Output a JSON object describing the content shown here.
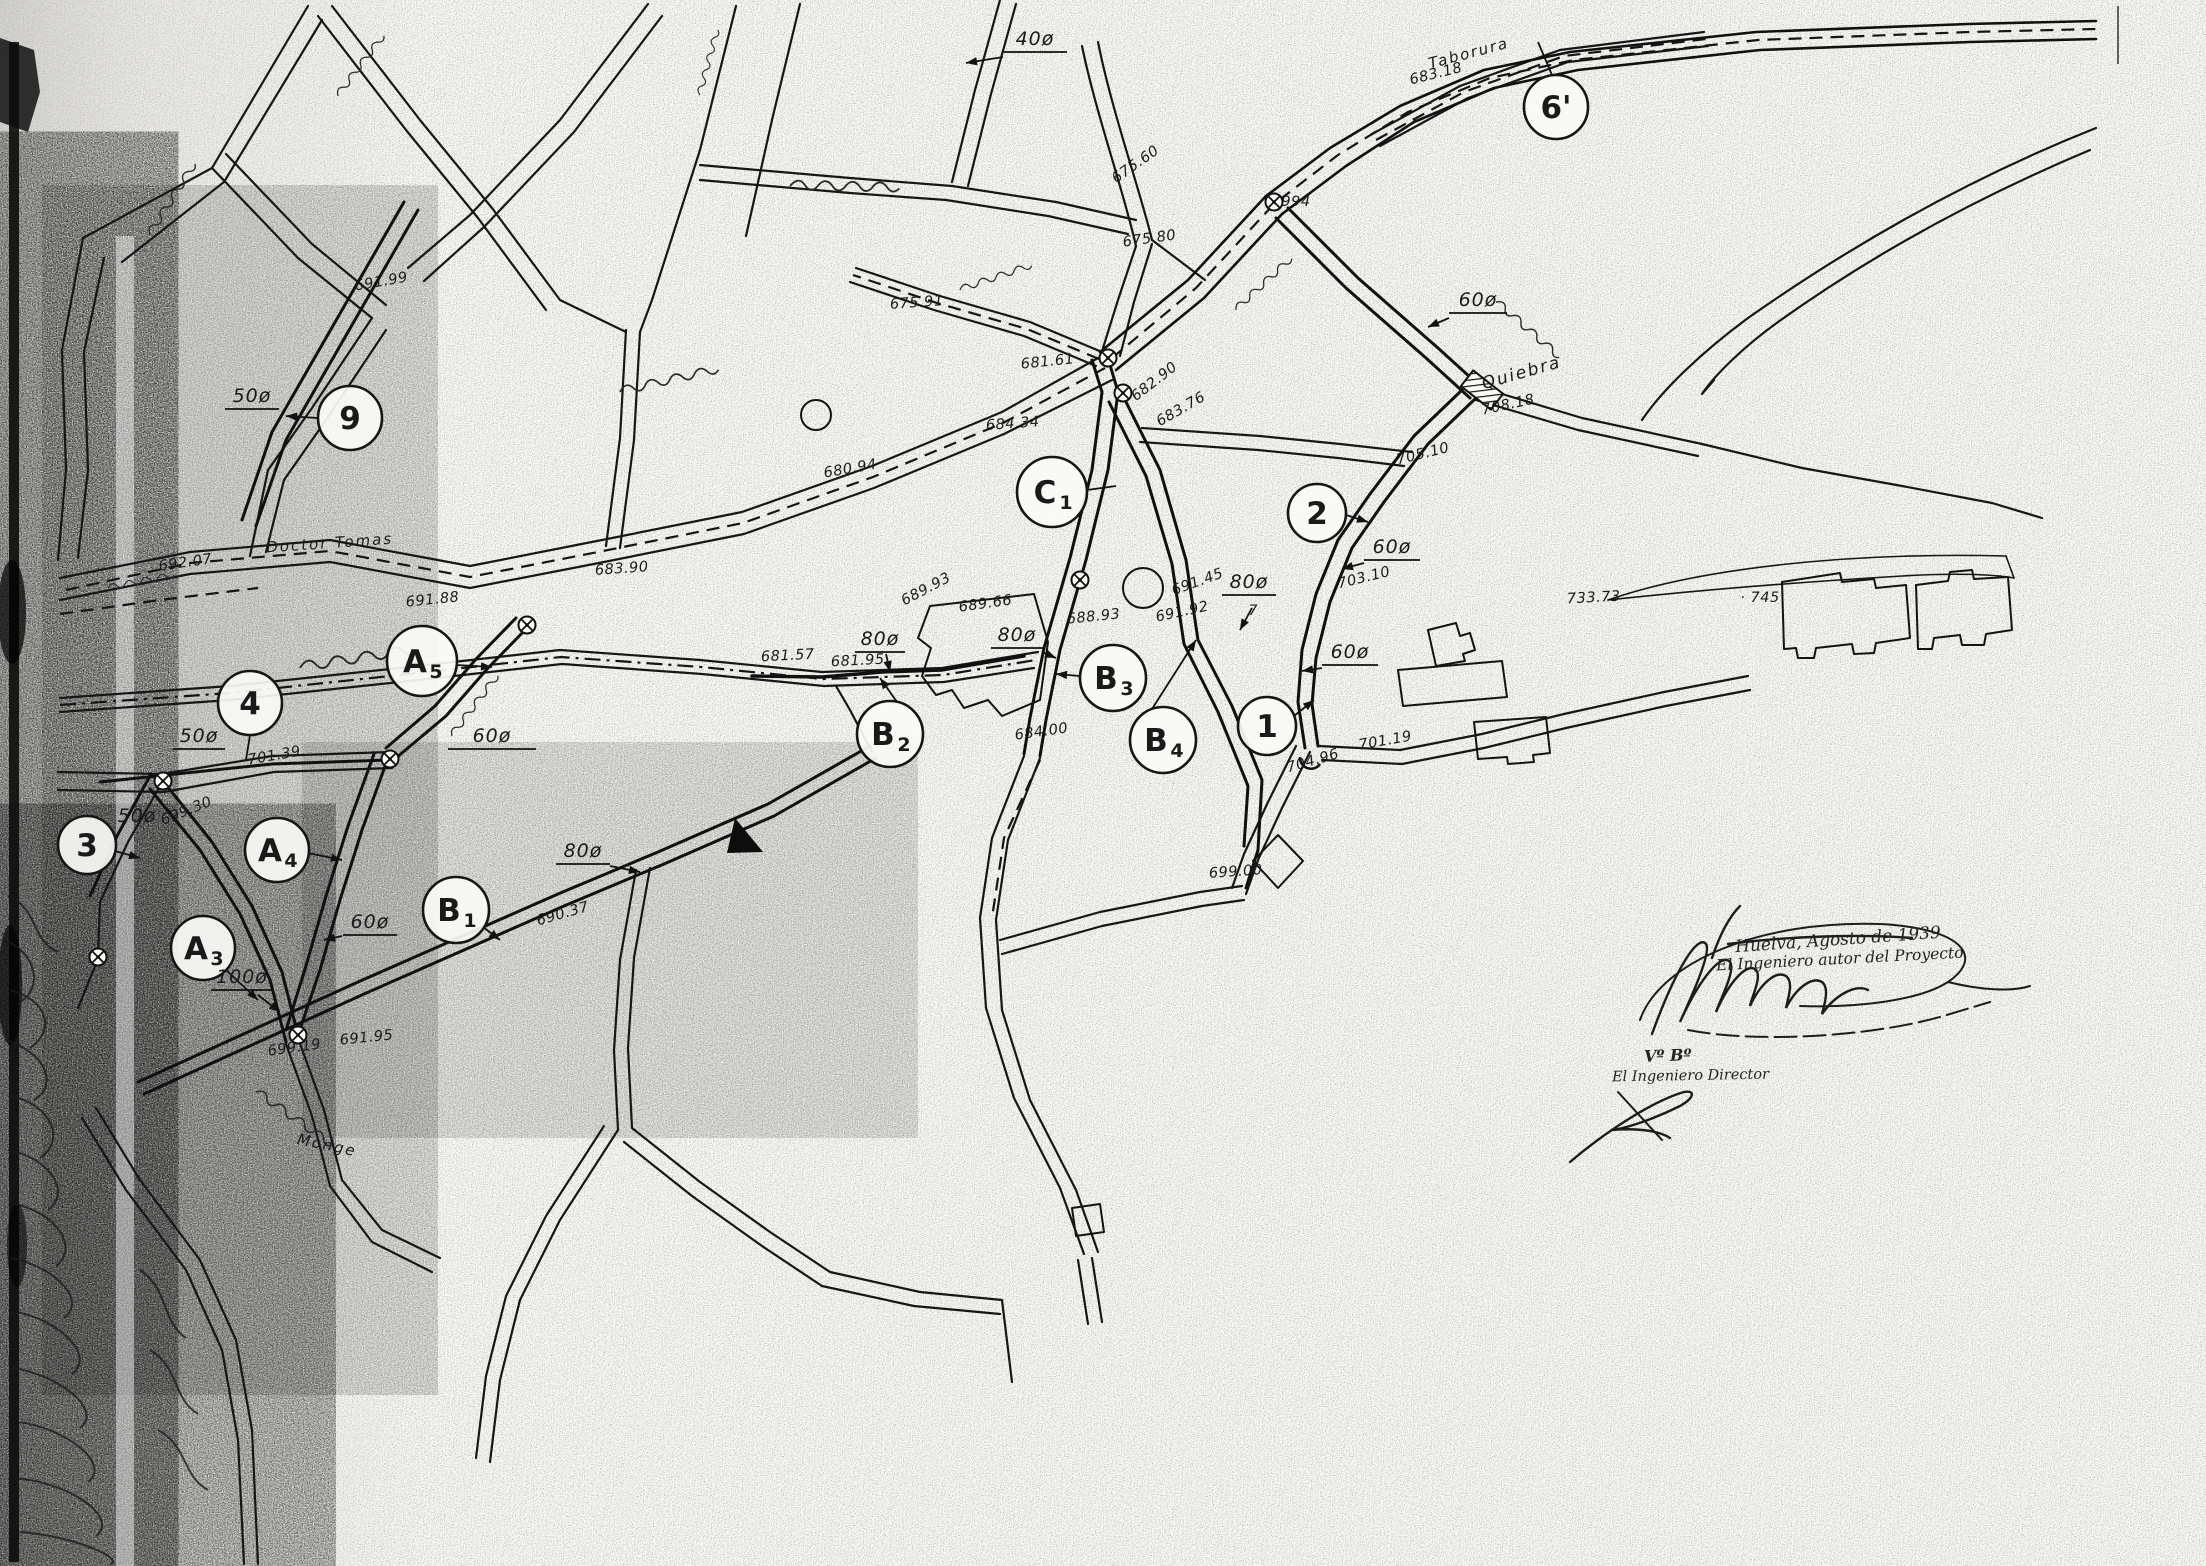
{
  "signatures": {
    "author_block": {
      "place_date": "Huelva, Agosto de 1939",
      "role": "El Ingeniero autor del Proyecto"
    },
    "approval_block": {
      "seen": "Vº Bº",
      "role": "El Ingeniero Director"
    }
  },
  "street_names": [
    {
      "t": "Quiebra",
      "x": 1523,
      "y": 378,
      "rot": -16,
      "size": 17
    },
    {
      "t": "Doctor Tomas",
      "x": 330,
      "y": 548,
      "rot": -4,
      "size": 15
    },
    {
      "t": "Taborura",
      "x": 1470,
      "y": 58,
      "rot": -15,
      "size": 15
    },
    {
      "t": "Monge",
      "x": 326,
      "y": 1150,
      "rot": 12,
      "size": 15
    }
  ],
  "node_labels": [
    {
      "t": "9",
      "sub": "",
      "x": 350,
      "y": 418,
      "r": 32,
      "leader": [
        318,
        418,
        286,
        416
      ],
      "arrow": true
    },
    {
      "t": "4",
      "sub": "",
      "x": 250,
      "y": 703,
      "r": 32,
      "leader": [
        250,
        735,
        246,
        760
      ],
      "arrow": false
    },
    {
      "t": "3",
      "sub": "",
      "x": 87,
      "y": 845,
      "r": 29,
      "leader": [
        115,
        851,
        140,
        858
      ],
      "arrow": true
    },
    {
      "t": "A",
      "sub": "5",
      "x": 422,
      "y": 661,
      "r": 35,
      "leader": [
        456,
        665,
        492,
        667
      ],
      "arrow": true
    },
    {
      "t": "A",
      "sub": "4",
      "x": 277,
      "y": 850,
      "r": 32,
      "leader": [
        308,
        853,
        342,
        860
      ],
      "arrow": true
    },
    {
      "t": "A",
      "sub": "3",
      "x": 203,
      "y": 948,
      "r": 32,
      "leader": [
        226,
        970,
        258,
        1000
      ],
      "arrow": true
    },
    {
      "t": "B",
      "sub": "1",
      "x": 456,
      "y": 910,
      "r": 33,
      "leader": [
        483,
        927,
        500,
        940
      ],
      "arrow": true
    },
    {
      "t": "B",
      "sub": "2",
      "x": 890,
      "y": 734,
      "r": 33,
      "leader": [
        897,
        702,
        880,
        678
      ],
      "arrow": true
    },
    {
      "t": "B",
      "sub": "3",
      "x": 1113,
      "y": 678,
      "r": 33,
      "leader": [
        1080,
        676,
        1056,
        674
      ],
      "arrow": true
    },
    {
      "t": "B",
      "sub": "4",
      "x": 1163,
      "y": 740,
      "r": 33,
      "leader": [
        1152,
        709,
        1196,
        640
      ],
      "arrow": true
    },
    {
      "t": "C",
      "sub": "1",
      "x": 1052,
      "y": 492,
      "r": 35,
      "leader": [
        1087,
        490,
        1116,
        486
      ],
      "arrow": false
    },
    {
      "t": "1",
      "sub": "",
      "x": 1267,
      "y": 726,
      "r": 29,
      "leader": [
        1294,
        716,
        1314,
        700
      ],
      "arrow": true
    },
    {
      "t": "2",
      "sub": "",
      "x": 1317,
      "y": 513,
      "r": 29,
      "leader": [
        1346,
        515,
        1368,
        522
      ],
      "arrow": true
    },
    {
      "t": "6'",
      "sub": "",
      "x": 1556,
      "y": 107,
      "r": 32,
      "leader": [
        1552,
        75,
        1538,
        42
      ],
      "arrow": false
    }
  ],
  "diameter_labels": [
    {
      "t": "40ø",
      "x": 1035,
      "y": 45,
      "ul": 64,
      "arrow": [
        1003,
        57,
        966,
        63
      ],
      "sub": ""
    },
    {
      "t": "50ø",
      "x": 252,
      "y": 402,
      "ul": 54,
      "arrow": null,
      "sub": ""
    },
    {
      "t": "50ø",
      "x": 199,
      "y": 742,
      "ul": 52,
      "arrow": null,
      "sub": ""
    },
    {
      "t": "50ø",
      "x": 137,
      "y": 822,
      "ul": 0,
      "arrow": null,
      "sub": ""
    },
    {
      "t": "60ø",
      "x": 1478,
      "y": 306,
      "ul": 58,
      "arrow": [
        1449,
        318,
        1428,
        327
      ],
      "sub": ""
    },
    {
      "t": "60ø",
      "x": 1392,
      "y": 553,
      "ul": 56,
      "arrow": [
        1364,
        563,
        1342,
        569
      ],
      "sub": ""
    },
    {
      "t": "60ø",
      "x": 1350,
      "y": 658,
      "ul": 56,
      "arrow": [
        1322,
        668,
        1302,
        671
      ],
      "sub": ""
    },
    {
      "t": "60ø",
      "x": 492,
      "y": 742,
      "ul": 88,
      "arrow": null,
      "sub": ""
    },
    {
      "t": "60ø",
      "x": 370,
      "y": 928,
      "ul": 54,
      "arrow": [
        342,
        936,
        324,
        940
      ],
      "sub": ""
    },
    {
      "t": "80ø",
      "x": 583,
      "y": 857,
      "ul": 54,
      "arrow": [
        610,
        866,
        640,
        872
      ],
      "sub": ""
    },
    {
      "t": "80ø",
      "x": 880,
      "y": 645,
      "ul": 50,
      "arrow": [
        886,
        654,
        890,
        672
      ],
      "sub": ""
    },
    {
      "t": "80ø",
      "x": 1017,
      "y": 641,
      "ul": 52,
      "arrow": [
        1042,
        652,
        1056,
        658
      ],
      "sub": ""
    },
    {
      "t": "80ø",
      "x": 1249,
      "y": 588,
      "ul": 54,
      "arrow": [
        1252,
        608,
        1240,
        630
      ],
      "sub": "7"
    },
    {
      "t": "100ø",
      "x": 242,
      "y": 983,
      "ul": 62,
      "arrow": [
        258,
        995,
        280,
        1012
      ],
      "sub": ""
    }
  ],
  "elevation_labels": [
    {
      "t": "691.99",
      "x": 382,
      "y": 286,
      "rot": -10
    },
    {
      "t": "675.91",
      "x": 917,
      "y": 307,
      "rot": -4
    },
    {
      "t": "675.60",
      "x": 1138,
      "y": 168,
      "rot": -35
    },
    {
      "t": "675.80",
      "x": 1150,
      "y": 243,
      "rot": -8
    },
    {
      "t": "683.18",
      "x": 1437,
      "y": 78,
      "rot": -14
    },
    {
      "t": "994",
      "x": 1296,
      "y": 206,
      "rot": 0
    },
    {
      "t": "682.90",
      "x": 1157,
      "y": 385,
      "rot": -38
    },
    {
      "t": "683.76",
      "x": 1183,
      "y": 413,
      "rot": -30
    },
    {
      "t": "681.61",
      "x": 1048,
      "y": 366,
      "rot": -6
    },
    {
      "t": "684.34",
      "x": 1013,
      "y": 428,
      "rot": -4
    },
    {
      "t": "680.94",
      "x": 851,
      "y": 473,
      "rot": -10
    },
    {
      "t": "692.07",
      "x": 186,
      "y": 567,
      "rot": -8
    },
    {
      "t": "691.88",
      "x": 433,
      "y": 604,
      "rot": -6
    },
    {
      "t": "683.90",
      "x": 622,
      "y": 573,
      "rot": -4
    },
    {
      "t": "681.57",
      "x": 788,
      "y": 660,
      "rot": -3
    },
    {
      "t": "681.95",
      "x": 858,
      "y": 665,
      "rot": -3
    },
    {
      "t": "689.93",
      "x": 928,
      "y": 593,
      "rot": -28
    },
    {
      "t": "689.66",
      "x": 986,
      "y": 608,
      "rot": -8
    },
    {
      "t": "688.93",
      "x": 1094,
      "y": 621,
      "rot": -6
    },
    {
      "t": "691.45",
      "x": 1199,
      "y": 586,
      "rot": -20
    },
    {
      "t": "691.92",
      "x": 1183,
      "y": 616,
      "rot": -12
    },
    {
      "t": "684.00",
      "x": 1042,
      "y": 736,
      "rot": -8
    },
    {
      "t": "705.10",
      "x": 1424,
      "y": 458,
      "rot": -14
    },
    {
      "t": "708.18",
      "x": 1509,
      "y": 409,
      "rot": -12
    },
    {
      "t": "703.10",
      "x": 1365,
      "y": 582,
      "rot": -14
    },
    {
      "t": "704.96",
      "x": 1314,
      "y": 765,
      "rot": -16
    },
    {
      "t": "701.19",
      "x": 1386,
      "y": 745,
      "rot": -10
    },
    {
      "t": "699.00",
      "x": 1236,
      "y": 876,
      "rot": -4
    },
    {
      "t": "733.73",
      "x": 1594,
      "y": 602,
      "rot": -3
    },
    {
      "t": "· 745",
      "x": 1760,
      "y": 602,
      "rot": 0
    },
    {
      "t": "690.37",
      "x": 564,
      "y": 918,
      "rot": -16
    },
    {
      "t": "699.30",
      "x": 188,
      "y": 815,
      "rot": -22
    },
    {
      "t": "701.39",
      "x": 275,
      "y": 760,
      "rot": -10
    },
    {
      "t": "699.19",
      "x": 295,
      "y": 1052,
      "rot": -8
    },
    {
      "t": "691.95",
      "x": 367,
      "y": 1042,
      "rot": -6
    }
  ],
  "valves": [
    [
      1274,
      202
    ],
    [
      1108,
      358
    ],
    [
      1123,
      393
    ],
    [
      1080,
      580
    ],
    [
      527,
      625
    ],
    [
      390,
      759
    ],
    [
      163,
      781
    ],
    [
      98,
      957
    ],
    [
      298,
      1035
    ]
  ],
  "colors": {
    "ink": "#1a1a1a",
    "paper": "#fbfaf6"
  }
}
